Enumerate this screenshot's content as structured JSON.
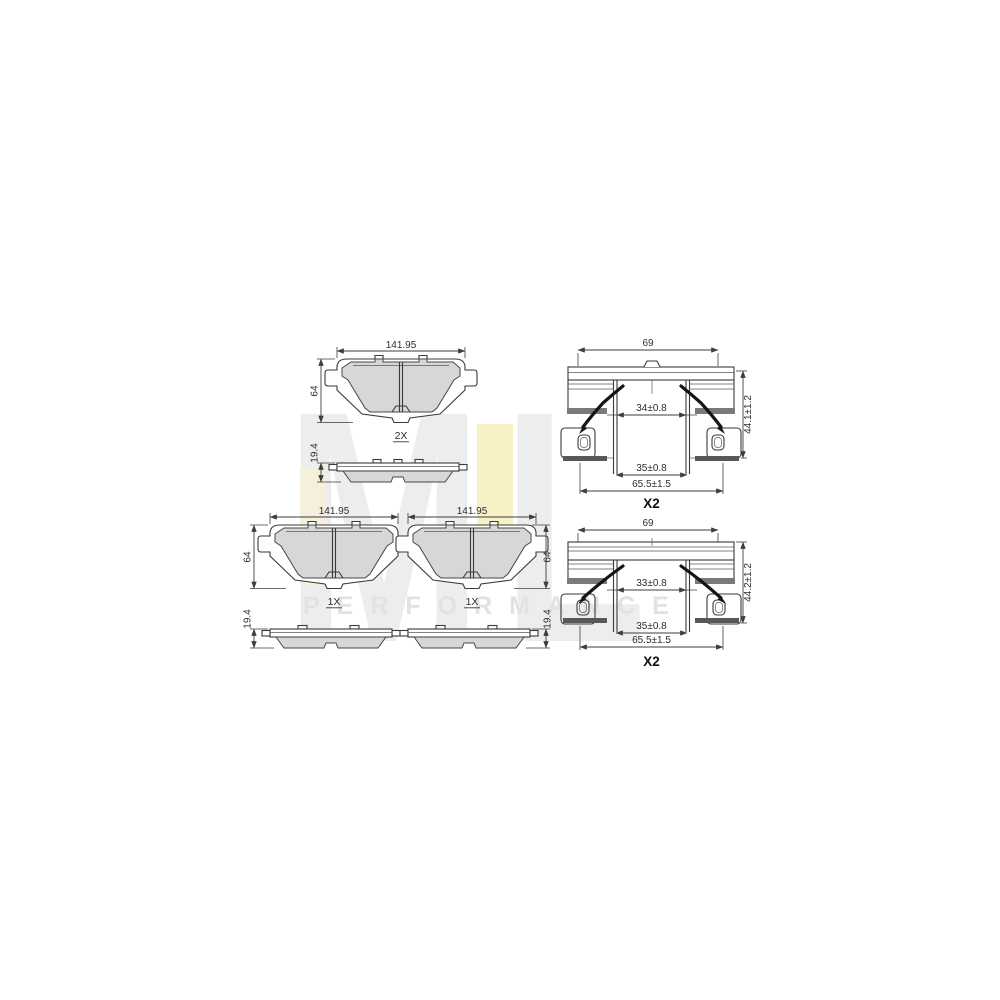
{
  "watermark": {
    "logo_text": "ML",
    "tagline": "PERFORMANCE",
    "logo_color": "#ededed",
    "accent_color": "#f8f1c6",
    "tagline_color": "#e2e2e2"
  },
  "drawings": {
    "pad_set_top": {
      "quantity_label": "2X",
      "width": "141.95",
      "height": "64",
      "thickness": "19.4"
    },
    "pad_mid_left": {
      "quantity_label": "1X",
      "width": "141.95",
      "height": "64",
      "thickness": "19.4"
    },
    "pad_mid_right": {
      "quantity_label": "1X",
      "width": "141.95",
      "height": "64",
      "thickness": "19.4"
    },
    "fitting_kit_top": {
      "quantity_label": "X2",
      "width": "69",
      "clip_inner_width": "34±0.8",
      "lower_inner_width": "35±0.8",
      "base_width": "65.5±1.5",
      "height": "44.1±1.2"
    },
    "fitting_kit_bottom": {
      "quantity_label": "X2",
      "width": "69",
      "clip_inner_width": "33±0.8",
      "lower_inner_width": "35±0.8",
      "base_width": "65.5±1.5",
      "height": "44.2±1.2"
    }
  }
}
